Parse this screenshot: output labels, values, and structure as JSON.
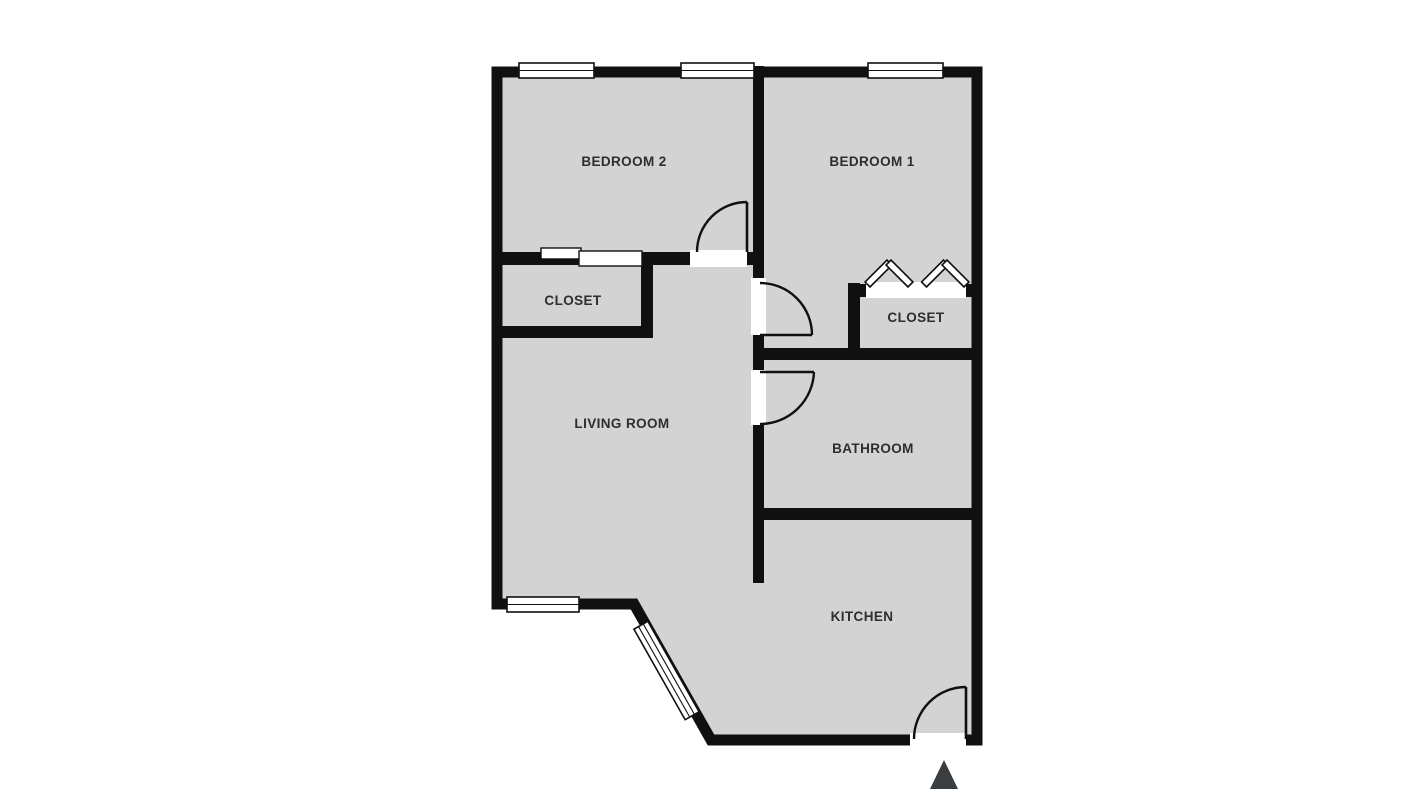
{
  "title": "Apartment floor plan",
  "colors": {
    "background": "#ffffff",
    "floor": "#d3d3d3",
    "wall": "#101010",
    "window_fill": "#ffffff",
    "label_text": "#2e2e2e",
    "entrance_arrow": "#3b3e40"
  },
  "rooms": {
    "bedroom2": {
      "label": "BEDROOM 2"
    },
    "bedroom1": {
      "label": "BEDROOM 1"
    },
    "closet_left": {
      "label": "CLOSET"
    },
    "closet_right": {
      "label": "CLOSET"
    },
    "living_room": {
      "label": "LIVING ROOM"
    },
    "bathroom": {
      "label": "BATHROOM"
    },
    "kitchen": {
      "label": "KITCHEN"
    }
  },
  "features": {
    "windows_count": 5,
    "swing_doors_count": 4,
    "sliding_door_location": "closet-left top wall",
    "bifold_marker_location": "closet-right opening",
    "entrance_marker": "triangle arrow below kitchen door (bottom right)",
    "angled_wall": "bottom-left of kitchen/living area with window"
  }
}
